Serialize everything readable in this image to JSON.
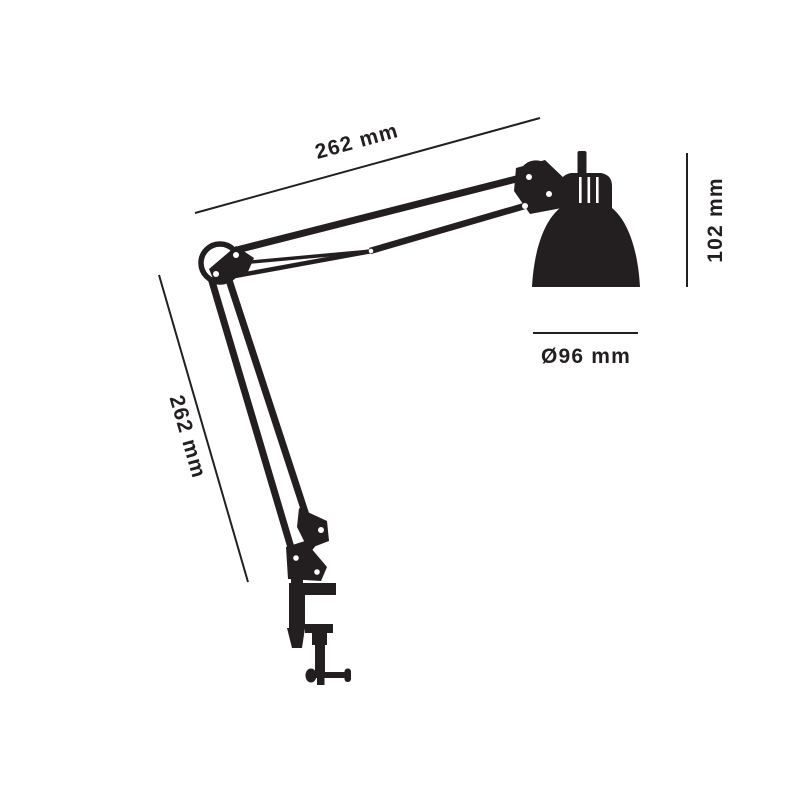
{
  "diagram": {
    "type": "product-dimension-drawing",
    "subject": "architect task lamp with desk clamp",
    "labels": {
      "upper_arm": "262 mm",
      "lower_arm": "262 mm",
      "shade_height": "102 mm",
      "shade_diameter": "Ø96 mm"
    },
    "values_mm": {
      "upper_arm": 262,
      "lower_arm": 262,
      "shade_height": 102,
      "shade_diameter": 96
    }
  },
  "colors": {
    "ink": "#231f20",
    "background": "#ffffff"
  }
}
